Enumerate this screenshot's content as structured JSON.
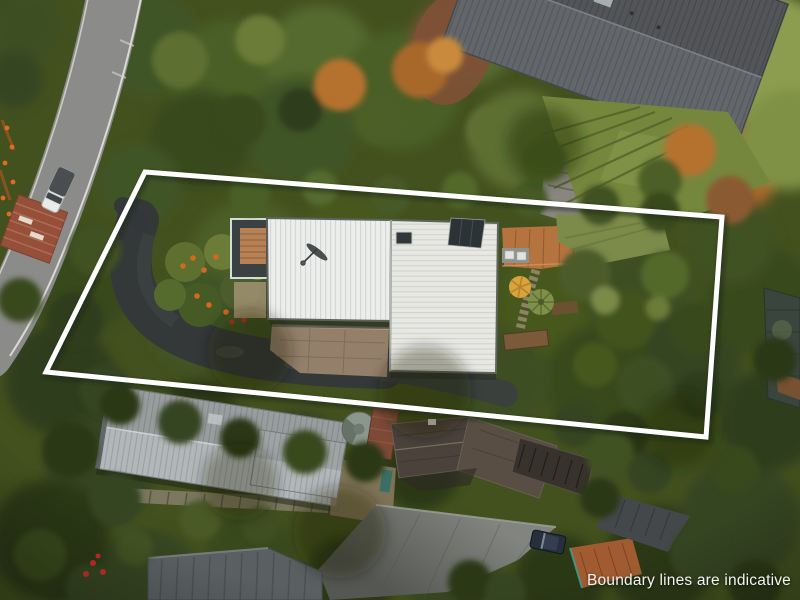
{
  "overlay": {
    "caption": "Boundary lines are indicative",
    "caption_color": "#f3f3f1",
    "boundary": {
      "points": "145,172 722,217 706,437 46,372",
      "color": "#ffffff",
      "shadow_color": "rgba(25,35,18,0.45)",
      "stroke_width": "5"
    }
  },
  "palette": {
    "roof_white_left": "#eceded",
    "roof_white_right": "#e7e8e4",
    "neighbor_roof_gray": "#63666a",
    "long_roof_gray": "#b2b7b9",
    "dark_tile_roof": "#4b423c",
    "road_gray": "#8b8b89",
    "deck_wood": "#b58155",
    "deck_terracotta": "#b5743f",
    "lawn_green": "#7c8a4a",
    "terrace_lawn": "#75873d",
    "foliage_dark": "#3c4f20",
    "foliage_mid": "#52692c",
    "foliage_autumn": "#b5722f",
    "driveway_dark": "#34383a"
  }
}
